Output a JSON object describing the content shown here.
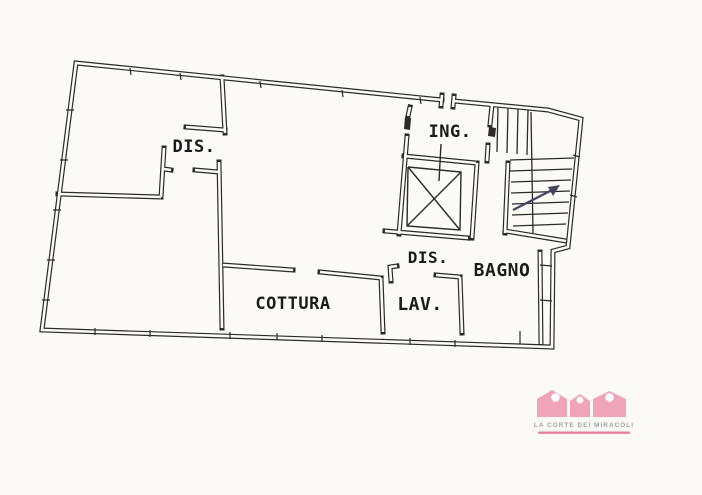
{
  "background_color": "#fbfaf7",
  "plan": {
    "line_color": "#2d2a27",
    "arrow_color": "#4a4160",
    "rooms": [
      {
        "label": "DIS."
      },
      {
        "label": "ING."
      },
      {
        "label": "DIS."
      },
      {
        "label": "BAGNO"
      },
      {
        "label": "COTTURA"
      },
      {
        "label": "LAV."
      }
    ]
  },
  "watermark": {
    "brand": "LA CORTE DEI MIRACOLI",
    "houses_color": "#f0a4ba",
    "window_color": "#fdfdfd",
    "underline_color": "#e8809d",
    "text_color": "#a0a0a0"
  }
}
